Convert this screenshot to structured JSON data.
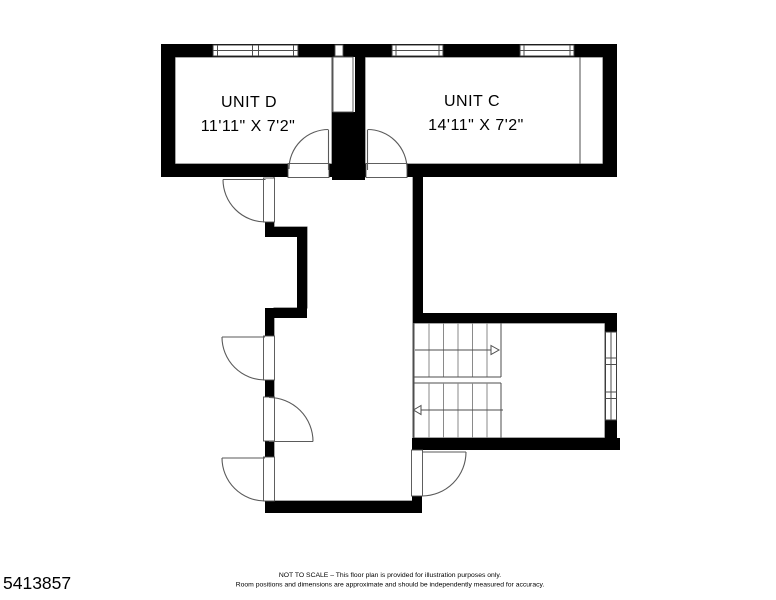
{
  "plan": {
    "rooms": [
      {
        "name": "UNIT D",
        "dimensions": "11'11\" X 7'2\""
      },
      {
        "name": "UNIT C",
        "dimensions": "14'11\" X 7'2\""
      }
    ],
    "features": [
      "windows",
      "doors",
      "staircase"
    ]
  },
  "footer": {
    "plan_number": "5413857",
    "disclaimer_line1": "NOT TO SCALE – This floor plan is provided for illustration purposes only.",
    "disclaimer_line2": "Room positions and dimensions are approximate and should be independently measured for accuracy."
  },
  "colors": {
    "wall": "#000000",
    "background": "#ffffff",
    "thin_line": "#4d4d4d"
  }
}
